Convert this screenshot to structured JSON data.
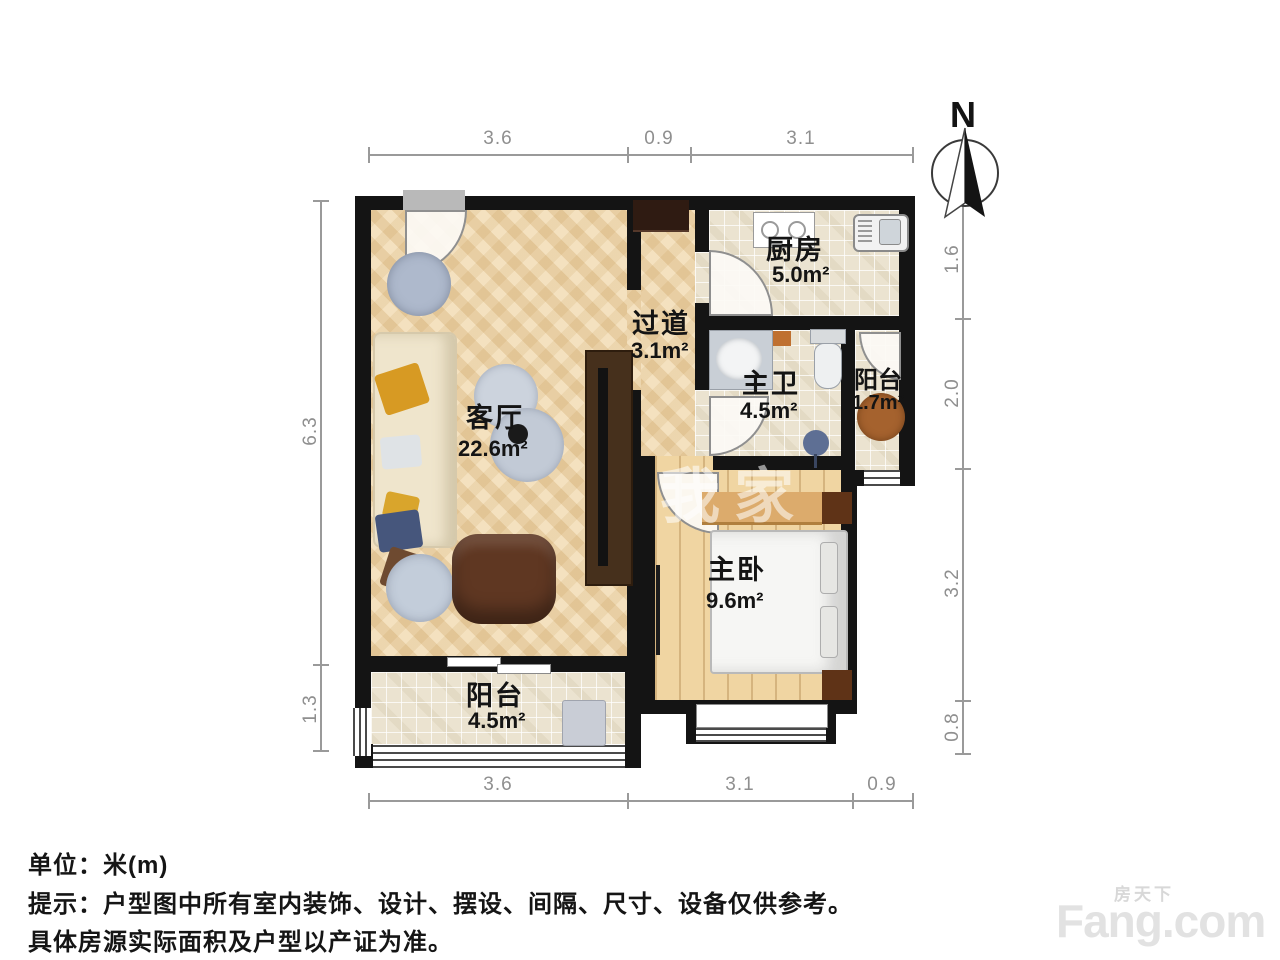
{
  "plan": {
    "rooms": [
      {
        "name": "客厅",
        "area": "22.6m²"
      },
      {
        "name": "过道",
        "area": "3.1m²"
      },
      {
        "name": "厨房",
        "area": "5.0m²"
      },
      {
        "name": "主卫",
        "area": "4.5m²"
      },
      {
        "name": "阳台",
        "area": "1.7m²"
      },
      {
        "name": "主卧",
        "area": "9.6m²"
      },
      {
        "name": "阳台",
        "area": "4.5m²"
      }
    ],
    "dimensions": {
      "top": [
        "3.6",
        "0.9",
        "3.1"
      ],
      "bottom": [
        "3.6",
        "3.1",
        "0.9"
      ],
      "left": [
        "6.3",
        "1.3"
      ],
      "right": [
        "1.6",
        "2.0",
        "3.2",
        "0.8"
      ]
    },
    "compass_label": "N",
    "watermark_center": "我家"
  },
  "footer": {
    "unit": "单位：米(m)",
    "note1": "提示：户型图中所有室内装饰、设计、摆设、间隔、尺寸、设备仅供参考。",
    "note2": "具体房源实际面积及户型以产证为准。"
  },
  "brand": {
    "cn": "房天下",
    "en": "Fang.com"
  }
}
